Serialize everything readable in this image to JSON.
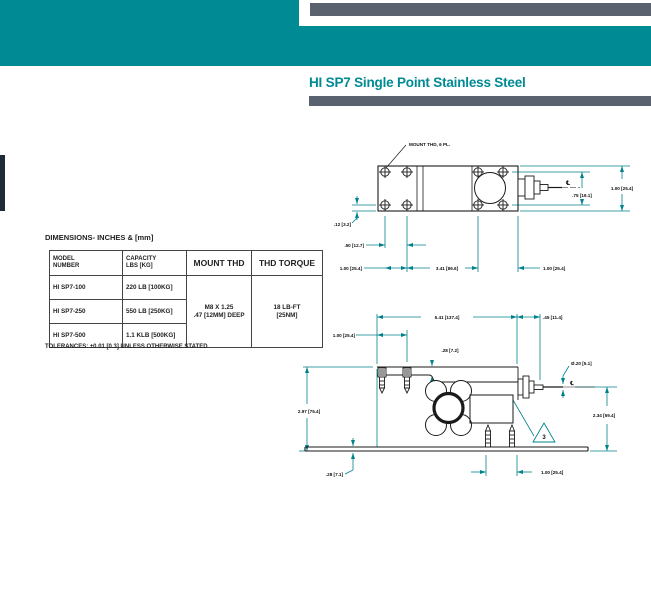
{
  "header": {
    "title": "HI SP7 Single Point Stainless Steel"
  },
  "colors": {
    "teal": "#008A94",
    "slate": "#59626E",
    "dimension_line": "#00828C",
    "ink": "#1A1A1A"
  },
  "dimensions_section": {
    "heading": "DIMENSIONS- INCHES & [mm]",
    "tolerance_note": "TOLERANCES: ±0.01 [0.3] UNLESS OTHERWISE STATED",
    "table": {
      "h_model_1": "MODEL",
      "h_model_2": "NUMBER",
      "h_capacity_1": "CAPACITY",
      "h_capacity_2": "LBS [KG]",
      "h_mount": "MOUNT THD",
      "h_torque": "THD TORQUE",
      "rows": [
        {
          "model": "HI SP7-100",
          "capacity": "220 LB [100KG]"
        },
        {
          "model": "HI SP7-250",
          "capacity": "550 LB [250KG]"
        },
        {
          "model": "HI SP7-500",
          "capacity": "1.1 KLB [500KG]"
        }
      ],
      "mount_1": "M8 X 1.25",
      "mount_2": ".47 [12MM] DEEP",
      "torque_1": "18 LB-FT",
      "torque_2": "[25NM]"
    }
  },
  "top_view": {
    "callout": "MOUNT THD, 6 PL.",
    "centerline_symbol": "℄",
    "dim_width": "1.00 [25.4]",
    "dim_hole_rows": ".75 [19.1]",
    "dim_edge_offset": ".12 [3.2]",
    "dim_col_spacing": ".50 [12.7]",
    "dim_left_end": "1.00 [25.4]",
    "dim_center_span": "3.41 [86.6]",
    "dim_right_end": "1.00 [25.4]"
  },
  "side_view": {
    "centerline_symbol": "℄",
    "dim_overall": "5.41 [137.4]",
    "dim_conn_offset": ".45 [11.4]",
    "dim_screw_offset": "1.00 [25.4]",
    "dim_step": ".28 [7.2]",
    "dim_pin_dia": "Ø.20 [5.1]",
    "dim_height": "2.97 [75.4]",
    "dim_conn_height": "2.34 [59.4]",
    "dim_base_thk": ".28 [7.1]",
    "dim_foot_spacing": "1.00 [25.4]",
    "flag_note": "3"
  }
}
